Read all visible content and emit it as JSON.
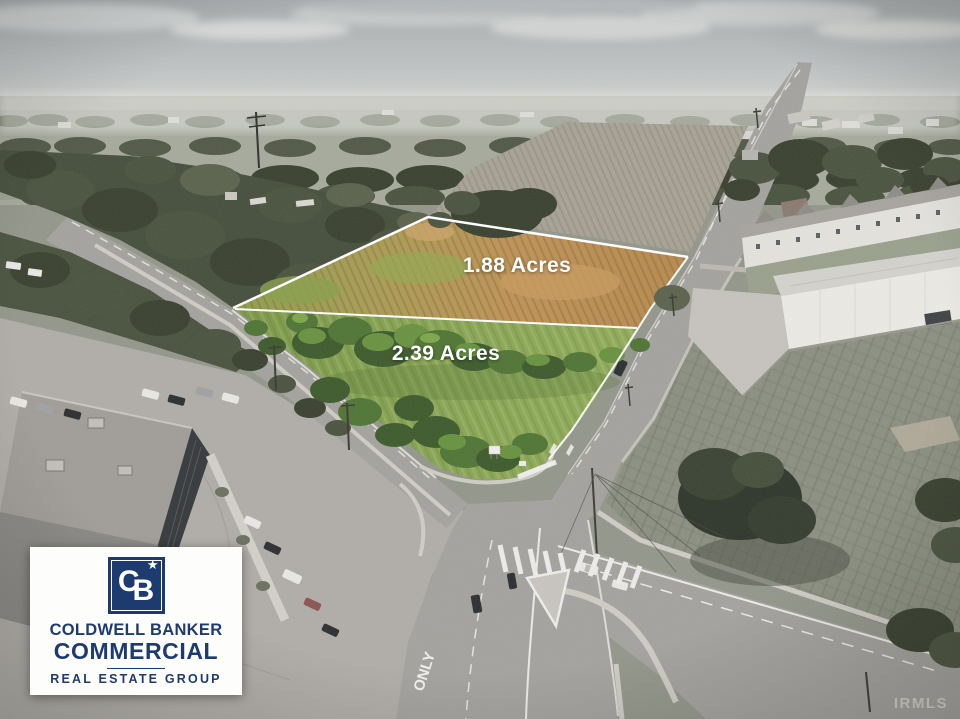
{
  "scene": {
    "description": "Aerial drone photo of two highlighted land parcels for sale at a suburban road intersection; surroundings desaturated, parcels shown in color with white boundary lines",
    "road_marking": "ONLY",
    "watermark": "IRMLS"
  },
  "parcels": {
    "north": {
      "label": "1.88 Acres"
    },
    "south": {
      "label": "2.39 Acres"
    }
  },
  "logo": {
    "monogram_c": "C",
    "monogram_b": "B",
    "star": "★",
    "line1": "COLDWELL BANKER",
    "line2": "COMMERCIAL",
    "line3": "REAL ESTATE GROUP"
  },
  "colors": {
    "brand_navy": "#1e3b70",
    "parcel_green": "#87a451",
    "parcel_tan": "#bf9255",
    "boundary_line": "#ffffff",
    "pavement_gray": "#a4a29e"
  }
}
